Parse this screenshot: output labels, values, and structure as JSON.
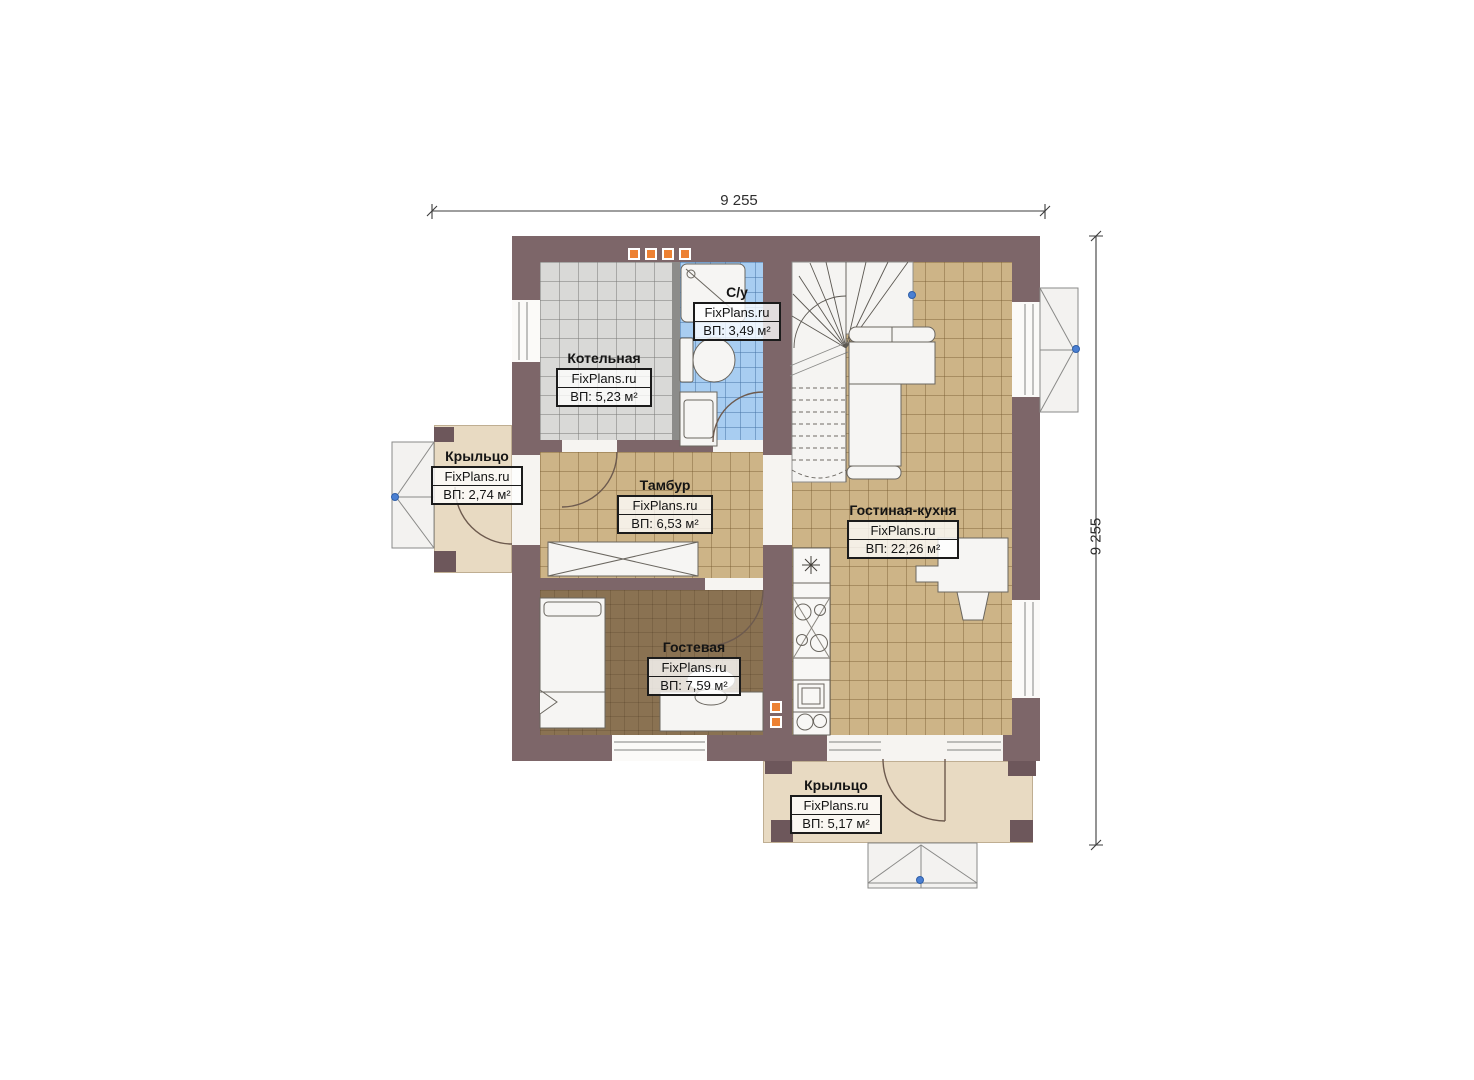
{
  "plan": {
    "watermark": "FixPlans.ru",
    "dimensions": {
      "width_label": "9 255",
      "height_label": "9 255"
    },
    "rooms": [
      {
        "key": "kotelnaya",
        "name": "Котельная",
        "brand": "FixPlans.ru",
        "area": "ВП: 5,23 м²"
      },
      {
        "key": "su",
        "name": "С/у",
        "brand": "FixPlans.ru",
        "area": "ВП: 3,49 м²"
      },
      {
        "key": "tambur",
        "name": "Тамбур",
        "brand": "FixPlans.ru",
        "area": "ВП: 6,53 м²"
      },
      {
        "key": "gostinaya-kuhnya",
        "name": "Гостиная-кухня",
        "brand": "FixPlans.ru",
        "area": "ВП: 22,26 м²"
      },
      {
        "key": "gostevaya",
        "name": "Гостевая",
        "brand": "FixPlans.ru",
        "area": "ВП: 7,59 м²"
      },
      {
        "key": "kryltso-left",
        "name": "Крыльцо",
        "brand": "FixPlans.ru",
        "area": "ВП: 2,74 м²"
      },
      {
        "key": "kryltso-bottom",
        "name": "Крыльцо",
        "brand": "FixPlans.ru",
        "area": "ВП: 5,17 м²"
      }
    ],
    "colors": {
      "wall": "#7d6669",
      "wall_dark": "#6d575b",
      "floor_tile_tan": "#cdb487",
      "floor_guest": "#8a7252",
      "floor_boiler": "#d9d9d7",
      "floor_bath": "#a8cdf1",
      "porch": "#e8dac2",
      "vent_orange": "#ed8133",
      "marker_blue": "#4a7fd2"
    }
  }
}
